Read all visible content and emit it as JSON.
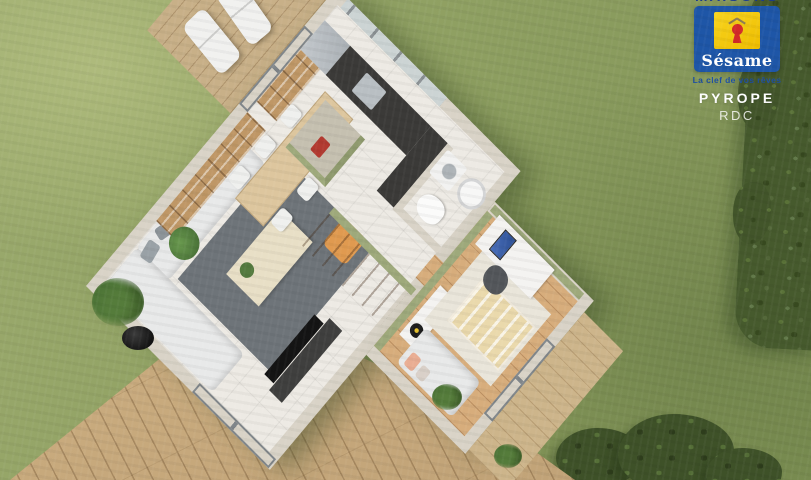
{
  "branding": {
    "brand_top_cropped": "MAISONS",
    "brand_name": "Sésame",
    "tagline": "La clef de vos rêves",
    "plan_name": "PYROPE",
    "floor_label": "RDC",
    "colors": {
      "panel_blue": "#1e56a7",
      "logo_yellow": "#f2c500",
      "keyhole_red": "#d42a28",
      "roof_gray": "#8d7b52",
      "tagline_blue": "#1d4fa3",
      "text_white": "#ffffff"
    }
  },
  "scene": {
    "description": "3D isometric render of a ground-floor house plan (RDC) on a lawn with wooden terraces and hedge",
    "palette": {
      "lawn": "#8fa062",
      "lawn_dark": "#7e9154",
      "hedge": "#465a2d",
      "deck_wood": "#c9ab7e",
      "wall_cream": "#d9d3c7",
      "tile_floor": "#edeae4",
      "accent_green": "#9ea97b",
      "bedroom_wood": "#d7ad7c",
      "rug_dark": "#6e7479",
      "sofa_white": "#e8e9e9",
      "pouf_orange": "#e09a50",
      "counter_dark": "#3b3a38",
      "stairs_wood": "#c99d66"
    },
    "rooms": [
      {
        "name": "living-room",
        "furniture": [
          "corner-sofa",
          "dark-gray-rug",
          "coffee-table-with-plant",
          "orange-pouf",
          "tv-on-cabinet",
          "two-wall-frames",
          "glass-sliding-door"
        ]
      },
      {
        "name": "dining-area",
        "furniture": [
          "wood-dining-table",
          "six-white-chairs",
          "long-bookshelf",
          "cube-shelf",
          "potted-plant"
        ]
      },
      {
        "name": "kitchen",
        "furniture": [
          "dark-l-counter",
          "sink",
          "fridge",
          "island-green-base-taupe-top",
          "red-toy-object"
        ]
      },
      {
        "name": "utility-closet",
        "furniture": [
          "washing-machine",
          "water-heater-cylinder"
        ]
      },
      {
        "name": "wc",
        "furniture": [
          "toilet"
        ]
      },
      {
        "name": "staircase",
        "furniture": [
          "wooden-steps",
          "green-accent-wall"
        ]
      },
      {
        "name": "bedroom-office",
        "furniture": [
          "sofa-bed-pink-pillows",
          "slatted-bed",
          "light-rug",
          "desk",
          "blue-screen-monitor",
          "office-chair",
          "turntable-cabinet",
          "glass-door"
        ]
      },
      {
        "name": "upper-terrace",
        "furniture": [
          "two-sun-loungers",
          "wood-planks",
          "glass-sliding-doors"
        ]
      },
      {
        "name": "lower-deck",
        "furniture": [
          "diagonal-wood-planks",
          "black-potted-plant"
        ]
      }
    ]
  }
}
